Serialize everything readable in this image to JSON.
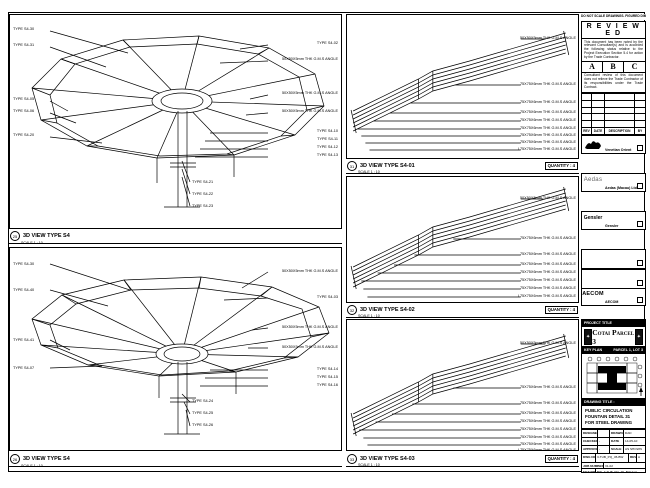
{
  "sheet": {
    "edge_note": "DO NOT SCALE DRAWINGS. FIGURED DIMENSIONS ONLY TO BE TAKEN. CONTRACTOR TO VERIFY ALL DIMENSIONS ON SITE."
  },
  "stamp": {
    "title": "R E V I E W E D",
    "para1": "This document has been noted by the relevant Consultant(s) and is accorded the following status relative to the Project Execution Section 5.4 for action by the Trade Contractor.",
    "grades": [
      "A",
      "B",
      "C"
    ],
    "para2": "Consultant review of this document does not relieve the Trade Contractor of its responsibilities under the Trade Contract.",
    "date_label": "Date :"
  },
  "revisions": {
    "headers": [
      "REV",
      "DATE",
      "DESCRIPTION",
      "BY"
    ]
  },
  "firms": [
    {
      "name": "Venetian Orient Limited"
    },
    {
      "logo": "Aedas",
      "name": "Aedas (Macau) Ltd."
    },
    {
      "logo": "Gensler",
      "name": "Gensler"
    },
    {
      "name": "Beca Professional Services Ltd."
    },
    {
      "logo": "AECOM",
      "name": "AECOM"
    },
    {
      "logo": "LangdonSeah",
      "name": "Langdon Seah"
    }
  ],
  "contractor": {
    "name": "Hsin Chong Construction (Macau) Co. Ltd."
  },
  "project": {
    "label": "PROJECT TITLE",
    "name": "Cotai Parcel 3"
  },
  "key_plan": {
    "label": "KEY PLAN",
    "parcel": "PARCEL 1, LOT 3"
  },
  "drawing_title": {
    "label": "DRAWING TITLE :",
    "lines": [
      "PUBLIC CIRCULATION",
      "FOUNTAIN DETAIL 31",
      "FOR STEEL DRAWING"
    ]
  },
  "title_block": {
    "designed_label": "DESIGNED",
    "designed": "",
    "drawn_label": "DRAWN",
    "drawn": "DAD",
    "checked_label": "CHECKED",
    "checked": "-",
    "date_label": "DATE",
    "date": "14-05-10",
    "approved_label": "APPROVED",
    "approved": "-",
    "scale_label": "SCALE",
    "scale": "AS SHOWN",
    "dwg_label": "DWG NO. :",
    "dwg_no": "3-TUB_PQ_45-BW",
    "rev_label": "REV :",
    "rev": "A",
    "job_label": "JOB NUMBER :",
    "job": "31-02",
    "file_label": "FILE NO :",
    "file": "BW_3-TUB_PQ_45_BW.dwg",
    "plot_label": "PLOT DATE :",
    "plot": "14-05-10"
  },
  "panels": {
    "a": {
      "ref": "25",
      "title": "3D VIEW TYPE S4",
      "scale": "SCALE  1 : 10",
      "left": [
        "TYPE S4-30",
        "TYPE S4-31",
        "TYPE S4-05",
        "TYPE S4-06",
        "TYPE S4-20"
      ],
      "right": [
        "TYPE S4-02",
        "50X50X5mm THK G.M.S ANGLE",
        "50X50X5mm THK G.M.S ANGLE",
        "50X50X5mm THK G.M.S ANGLE",
        "TYPE S4-10",
        "TYPE S4-11",
        "TYPE S4-12",
        "TYPE S4-13"
      ],
      "bottom": [
        "TYPE S4-21",
        "TYPE S4-22",
        "TYPE S4-23"
      ]
    },
    "b": {
      "ref": "26",
      "title": "3D VIEW TYPE S4",
      "scale": "SCALE  1 : 10",
      "left": [
        "TYPE S4-30",
        "TYPE S4-40",
        "TYPE S4-41",
        "TYPE S4-07"
      ],
      "right": [
        "50X50X5mm THK G.M.S ANGLE",
        "TYPE S4-03",
        "50X50X5mm THK G.M.S ANGLE",
        "50X50X5mm THK G.M.S ANGLE",
        "TYPE S4-14",
        "TYPE S4-15",
        "TYPE S4-16"
      ],
      "bottom": [
        "TYPE S4-24",
        "TYPE S4-25",
        "TYPE S4-26"
      ]
    },
    "c": {
      "ref": "31",
      "title": "3D VIEW TYPE S4-01",
      "scale": "SCALE  1 : 10",
      "quantity": "QUANTITY : 4",
      "labels": [
        "50X50X5mm THK G.M.S ANGLE",
        "75X75X6mm THK G.M.S ANGLE",
        "75X75X6mm THK G.M.S ANGLE",
        "75X75X6mm THK G.M.S ANGLE",
        "75X75X6mm THK G.M.S ANGLE",
        "75X75X6mm THK G.M.S ANGLE",
        "75X75X6mm THK G.M.S ANGLE",
        "75X75X6mm THK G.M.S ANGLE",
        "L75X75X6mm THK G.M.S ANGLE"
      ]
    },
    "d": {
      "ref": "32",
      "title": "3D VIEW TYPE S4-02",
      "scale": "SCALE  1 : 10",
      "quantity": "QUANTITY : 4",
      "labels": [
        "50X50X5mm THK G.M.S ANGLE",
        "75X75X6mm THK G.M.S ANGLE",
        "75X75X6mm THK G.M.S ANGLE",
        "75X75X6mm THK G.M.S ANGLE",
        "75X75X6mm THK G.M.S ANGLE",
        "75X75X6mm THK G.M.S ANGLE",
        "75X75X6mm THK G.M.S ANGLE",
        "L75X75X6mm THK G.M.S ANGLE"
      ]
    },
    "e": {
      "ref": "33",
      "title": "3D VIEW TYPE S4-03",
      "scale": "SCALE  1 : 10",
      "quantity": "QUANTITY : 4",
      "labels": [
        "50X50X5mm THK G.M.S ANGLE",
        "75X75X6mm THK G.M.S ANGLE",
        "75X75X6mm THK G.M.S ANGLE",
        "75X75X6mm THK G.M.S ANGLE",
        "75X75X6mm THK G.M.S ANGLE",
        "75X75X6mm THK G.M.S ANGLE",
        "75X75X6mm THK G.M.S ANGLE",
        "75X75X6mm THK G.M.S ANGLE",
        "L75X75X6mm THK G.M.S ANGLE"
      ]
    }
  }
}
